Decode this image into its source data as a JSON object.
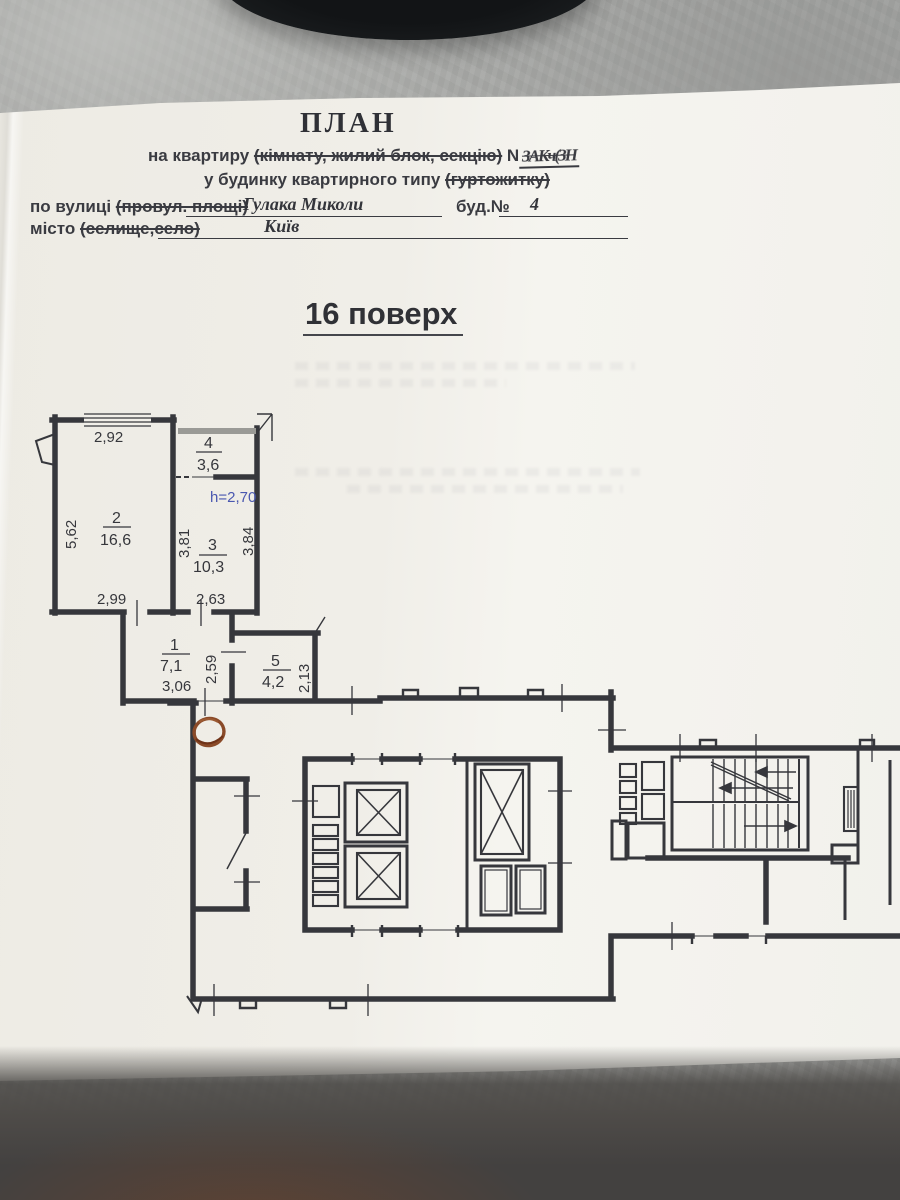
{
  "scene": {
    "paper_color": "#f1efe9",
    "ink_color": "#36373c",
    "blue_note_color": "#4a58b0",
    "stamp_color": "#8a4a28",
    "table_color": "#a4a5a3"
  },
  "header": {
    "title": "ПЛАН",
    "subtitle_prefix": "на квартиру",
    "subtitle_struck": "(кімнату, жилий блок, секцію)",
    "subtitle_number_label": "N",
    "subtitle_number_scribble": "ЗАКч(ЗН",
    "building_type_prefix": "у будинку квартирного типу",
    "building_type_struck": "(гуртожитку)",
    "street_label": "по вулиці",
    "street_struck": "(провул. площі)",
    "street_value": "Гулака Миколи",
    "building_no_label": "буд.№",
    "building_no_value": "4",
    "city_label": "місто",
    "city_struck": "(селище,село)",
    "city_value": "Київ"
  },
  "floor_title": "16 поверх",
  "plan": {
    "height_note": "h=2,70",
    "rooms": [
      {
        "number": "1",
        "area": "7,1"
      },
      {
        "number": "2",
        "area": "16,6"
      },
      {
        "number": "3",
        "area": "10,3"
      },
      {
        "number": "4",
        "area": "3,6"
      },
      {
        "number": "5",
        "area": "4,2"
      }
    ],
    "dimensions": {
      "room2_width_top": "2,92",
      "room2_height_left": "5,62",
      "room2_width_bottom": "2,99",
      "room3_height_left": "3,81",
      "room3_height_right": "3,84",
      "room3_width_bottom": "2,63",
      "room1_width_bottom": "3,06",
      "room1_height_right": "2,59",
      "room5_height_right": "2,13"
    }
  }
}
